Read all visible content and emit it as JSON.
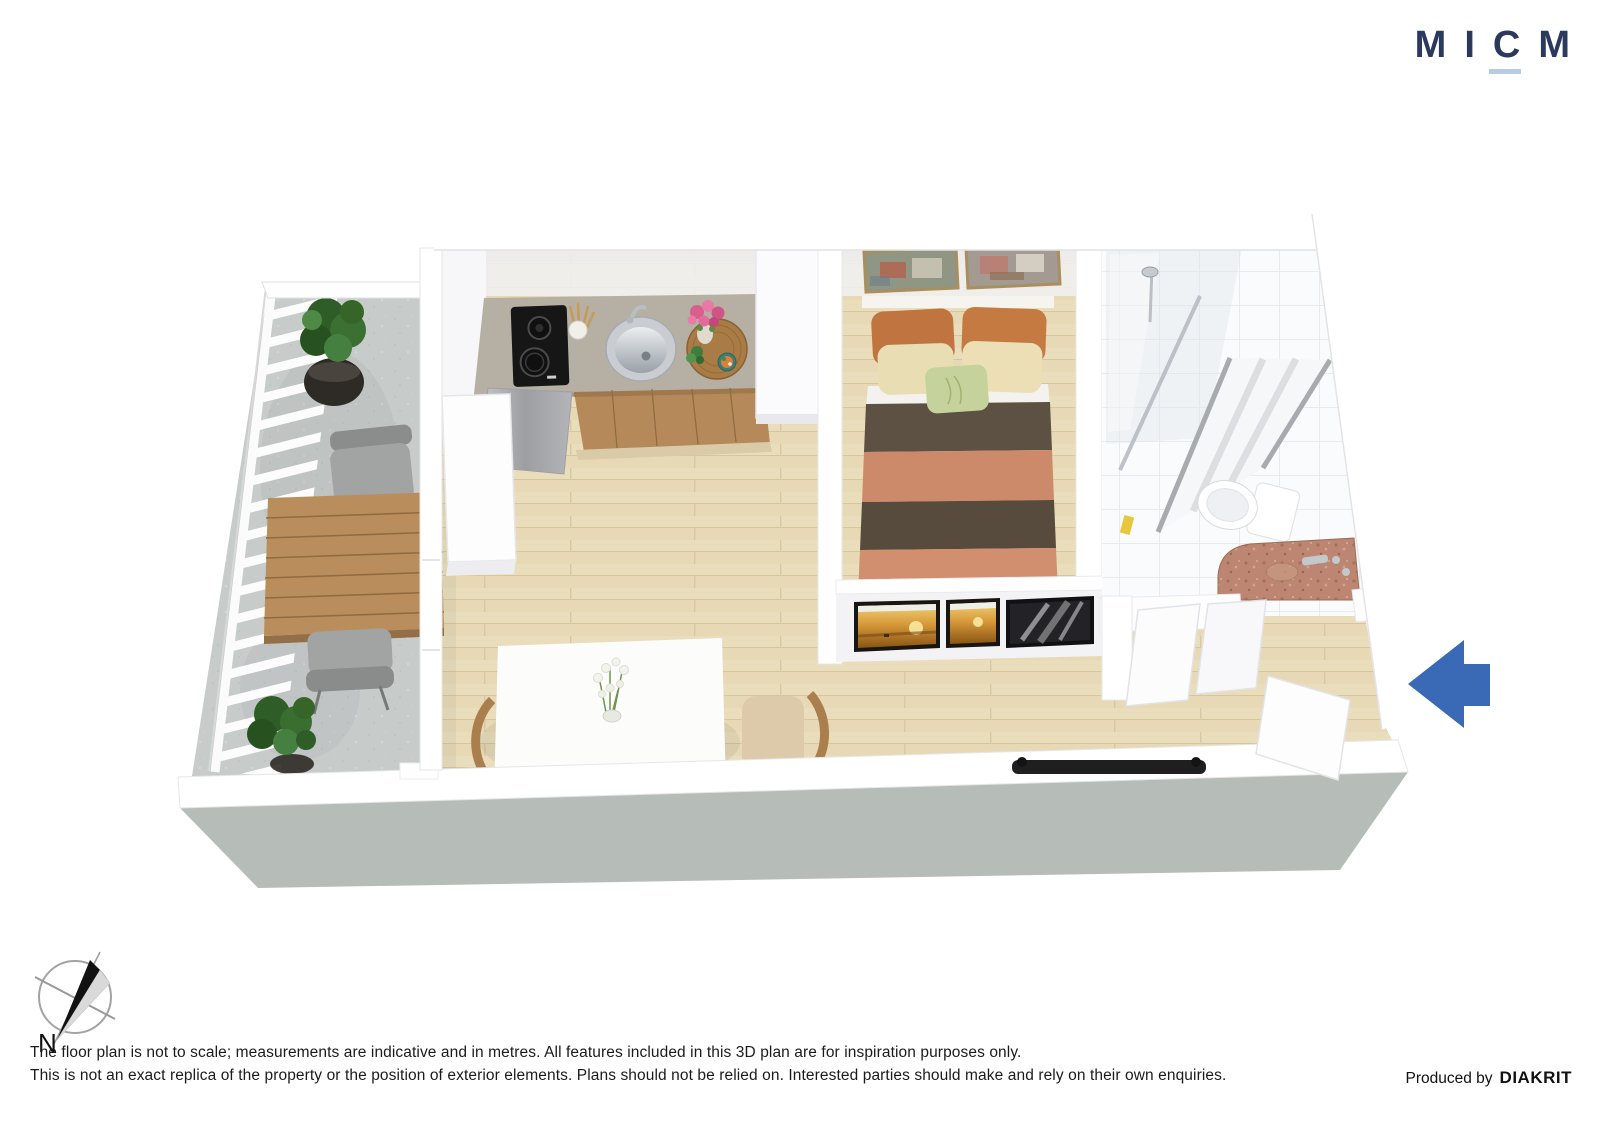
{
  "page": {
    "background_color": "#ffffff"
  },
  "logo": {
    "letters": [
      "M",
      "I",
      "C",
      "M"
    ],
    "color": "#2b3a5c",
    "underline_color": "#b9cbe2"
  },
  "floorplan": {
    "view": "3d-isometric-floor-plan",
    "rooms": [
      "balcony",
      "kitchen",
      "living-dining",
      "bedroom",
      "bathroom",
      "entry-hall"
    ],
    "colors": {
      "wood_floor": "#e9ddbc",
      "balcony_concrete": "#c7cbca",
      "wall": "#ffffff",
      "foundation_slab": "#b6bdb8",
      "bed_salmon": "#cd8a6b",
      "bed_brown": "#5d5143",
      "pillow_orange": "#c07440",
      "pillow_cream": "#e9ddb4",
      "pillow_green": "#c6d29b",
      "cabinet_wood": "#b5895a",
      "kitchen_counter": "#b6b0a4",
      "vanity_granite": "#bd8672",
      "outdoor_table_wood": "#b98e5c"
    }
  },
  "entry_arrow": {
    "direction": "left",
    "color": "#3a6ab5"
  },
  "compass": {
    "label": "N"
  },
  "footer": {
    "line1": "The floor plan is not to scale; measurements are indicative and in metres. All features included in this 3D plan are for inspiration purposes only.",
    "line2": "This is not an exact replica of the property or the position of exterior elements. Plans should not be relied on. Interested parties should make and rely on their own enquiries.",
    "produced_by": "Produced by",
    "brand": "DIAKRIT"
  }
}
